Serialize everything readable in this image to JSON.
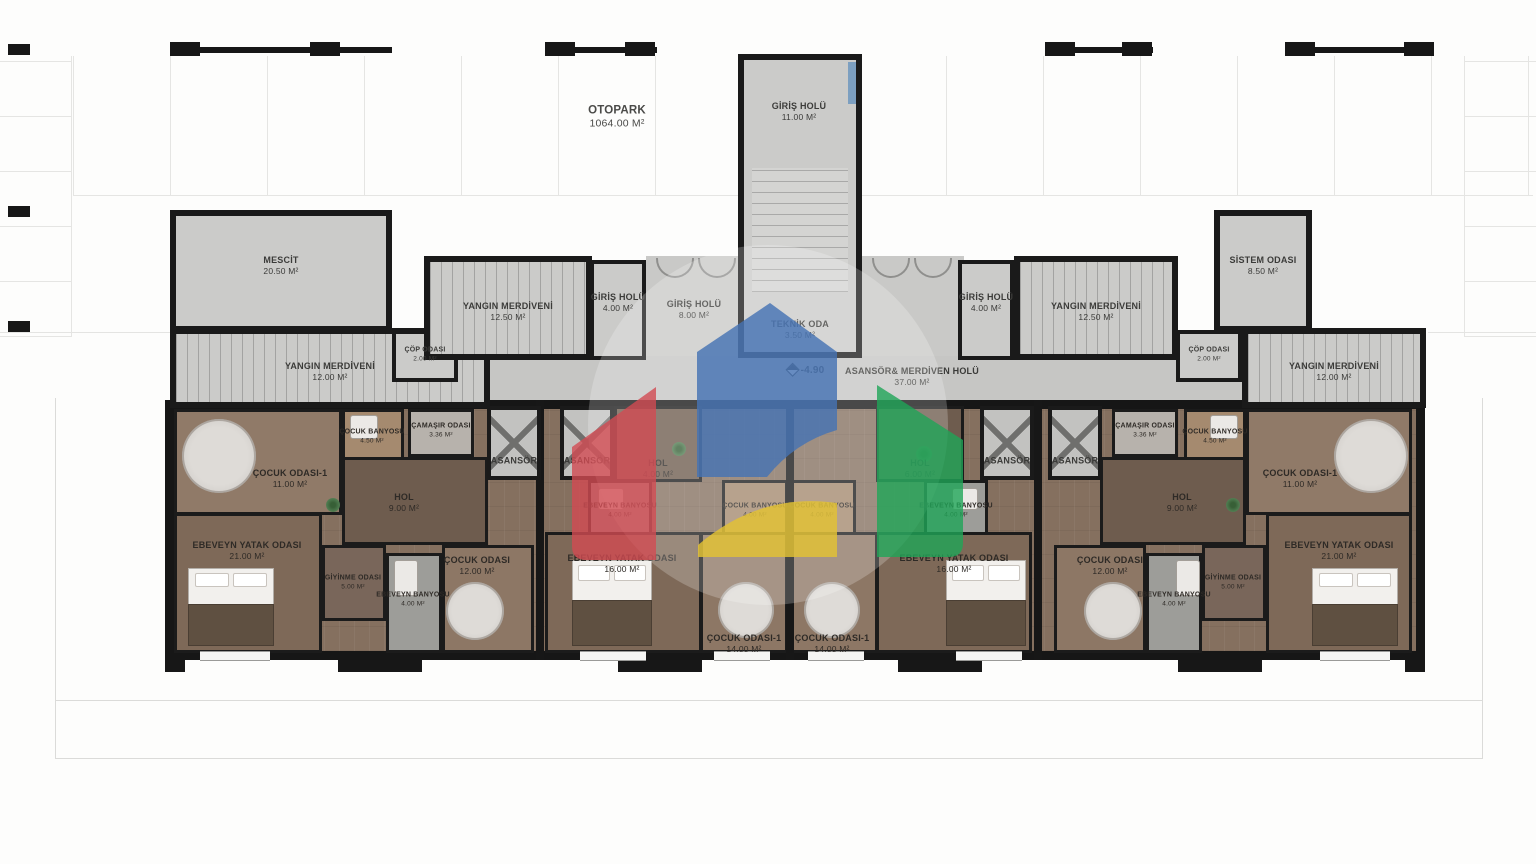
{
  "plan": {
    "otopark": {
      "name": "OTOPARK",
      "area": "1064.00 M²"
    },
    "giris_holu_11": {
      "name": "GİRİŞ HOLÜ",
      "area": "11.00 M²"
    },
    "mescit": {
      "name": "MESCİT",
      "area": "20.50 M²"
    },
    "yangin_12": {
      "name": "YANGIN MERDİVENİ",
      "area": "12.00 M²"
    },
    "yangin_125": {
      "name": "YANGIN MERDİVENİ",
      "area": "12.50 M²"
    },
    "cop_odasi": {
      "name": "ÇÖP ODASI",
      "area": "2.00 M²"
    },
    "giris_holu_4": {
      "name": "GİRİŞ HOLÜ",
      "area": "4.00 M²"
    },
    "giris_holu_8": {
      "name": "GİRİŞ HOLÜ",
      "area": "8.00 M²"
    },
    "teknik_oda": {
      "name": "TEKNİK ODA",
      "area": "3.50 M²"
    },
    "asansor_holu": {
      "name": "ASANSÖR& MERDİVEN HOLÜ",
      "area": "37.00 M²"
    },
    "sistem_odasi": {
      "name": "SİSTEM ODASI",
      "area": "8.50 M²"
    },
    "asansor": {
      "name": "ASANSÖR"
    },
    "elevation": "-4.90",
    "cocuk_odasi_1_11": {
      "name": "ÇOCUK ODASI-1",
      "area": "11.00 M²"
    },
    "cocuk_banyosu_45": {
      "name": "ÇOCUK BANYOSU",
      "area": "4.50 M²"
    },
    "camasir_odasi": {
      "name": "ÇAMAŞIR ODASI",
      "area": "3.36 M²"
    },
    "hol_9": {
      "name": "HOL",
      "area": "9.00 M²"
    },
    "hol_4": {
      "name": "HOL",
      "area": "4.00 M²"
    },
    "hol_6": {
      "name": "HOL",
      "area": "6.00 M²"
    },
    "ebeveyn_yatak_21": {
      "name": "EBEVEYN YATAK ODASI",
      "area": "21.00 M²"
    },
    "ebeveyn_yatak_16": {
      "name": "EBEVEYN YATAK ODASI",
      "area": "16.00 M²"
    },
    "giyinme_odasi": {
      "name": "GİYİNME ODASI",
      "area": "5.00 M²"
    },
    "ebeveyn_banyosu_4": {
      "name": "EBEVEYN BANYOSU",
      "area": "4.00 M²"
    },
    "cocuk_odasi_12": {
      "name": "ÇOCUK ODASI",
      "area": "12.00 M²"
    },
    "cocuk_banyosu_4": {
      "name": "ÇOCUK BANYOSU",
      "area": "4.00 M²"
    },
    "cocuk_odasi_1_14": {
      "name": "ÇOCUK ODASI-1",
      "area": "14.00 M²"
    }
  },
  "watermark": {
    "blue": "#4673b3",
    "red": "#d24b52",
    "green": "#1fa557",
    "yellow": "#e3c233"
  }
}
